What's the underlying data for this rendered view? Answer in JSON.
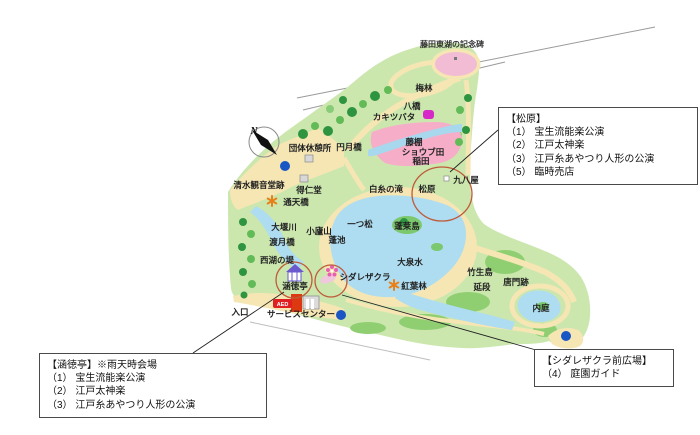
{
  "boxes": {
    "matsubara": {
      "title": "【松原】",
      "items": [
        "（1） 宝生流能楽公演",
        "（2） 江戸太神楽",
        "（3） 江戸糸あやつり人形の公演",
        "（5） 臨時売店"
      ]
    },
    "kantokutei": {
      "title": "【涵徳亭】※雨天時会場",
      "items": [
        "（1） 宝生流能楽公演",
        "（2） 江戸太神楽",
        "（3） 江戸糸あやつり人形の公演"
      ]
    },
    "shidarezakura_hiroba": {
      "title": "【シダレザクラ前広場】",
      "items": [
        "（4） 庭園ガイド"
      ]
    }
  },
  "map": {
    "labels": {
      "fujita_monument": "藤田東湖の記念碑",
      "bairin": "梅林",
      "yatsuhashi": "八橋",
      "kakitsubata": "カキツバタ",
      "engetsukyo": "円月橋",
      "dantai_kyukeijo": "団体休憩所",
      "fujidana": "藤棚",
      "shobuda": "ショウブ田",
      "inada": "稲田",
      "kuhachiya": "九八屋",
      "shimizu_kannondo": "清水観音堂跡",
      "tokujindo": "得仁堂",
      "tsutenkyo": "通天橋",
      "shiraito_no_taki": "白糸の滝",
      "matsubara": "松原",
      "hitotsumatsu": "一つ松",
      "horaijima": "蓬莱島",
      "yomogiike": "蓬池",
      "daisensui": "大泉水",
      "oigawa": "大堰川",
      "shorozan": "小廬山",
      "togetsukyo": "渡月橋",
      "saiko_no_tsutsumi": "西湖の堤",
      "kantokutei": "涵徳亭",
      "shidarezakura": "シダレザクラ",
      "koyorin": "紅葉林",
      "chikubushima": "竹生島",
      "nobedan": "延段",
      "karamon_ato": "唐門跡",
      "naitei": "内庭",
      "iriguchi": "入口",
      "service_center": "サービスセンター"
    },
    "badges": {
      "aed": "AED"
    },
    "compass": {
      "north": "N"
    },
    "colors": {
      "ground": "#cbe7ae",
      "path_tan": "#f5e6b4",
      "water": "#aedcf0",
      "field_pink": "#f6aec8",
      "plum_pink": "#f2bcd4",
      "highlight_circle": "#bf5b3a",
      "marker_blue": "#1a56c4",
      "aed_red": "#e02020",
      "magenta_flower": "#d629c8"
    }
  }
}
